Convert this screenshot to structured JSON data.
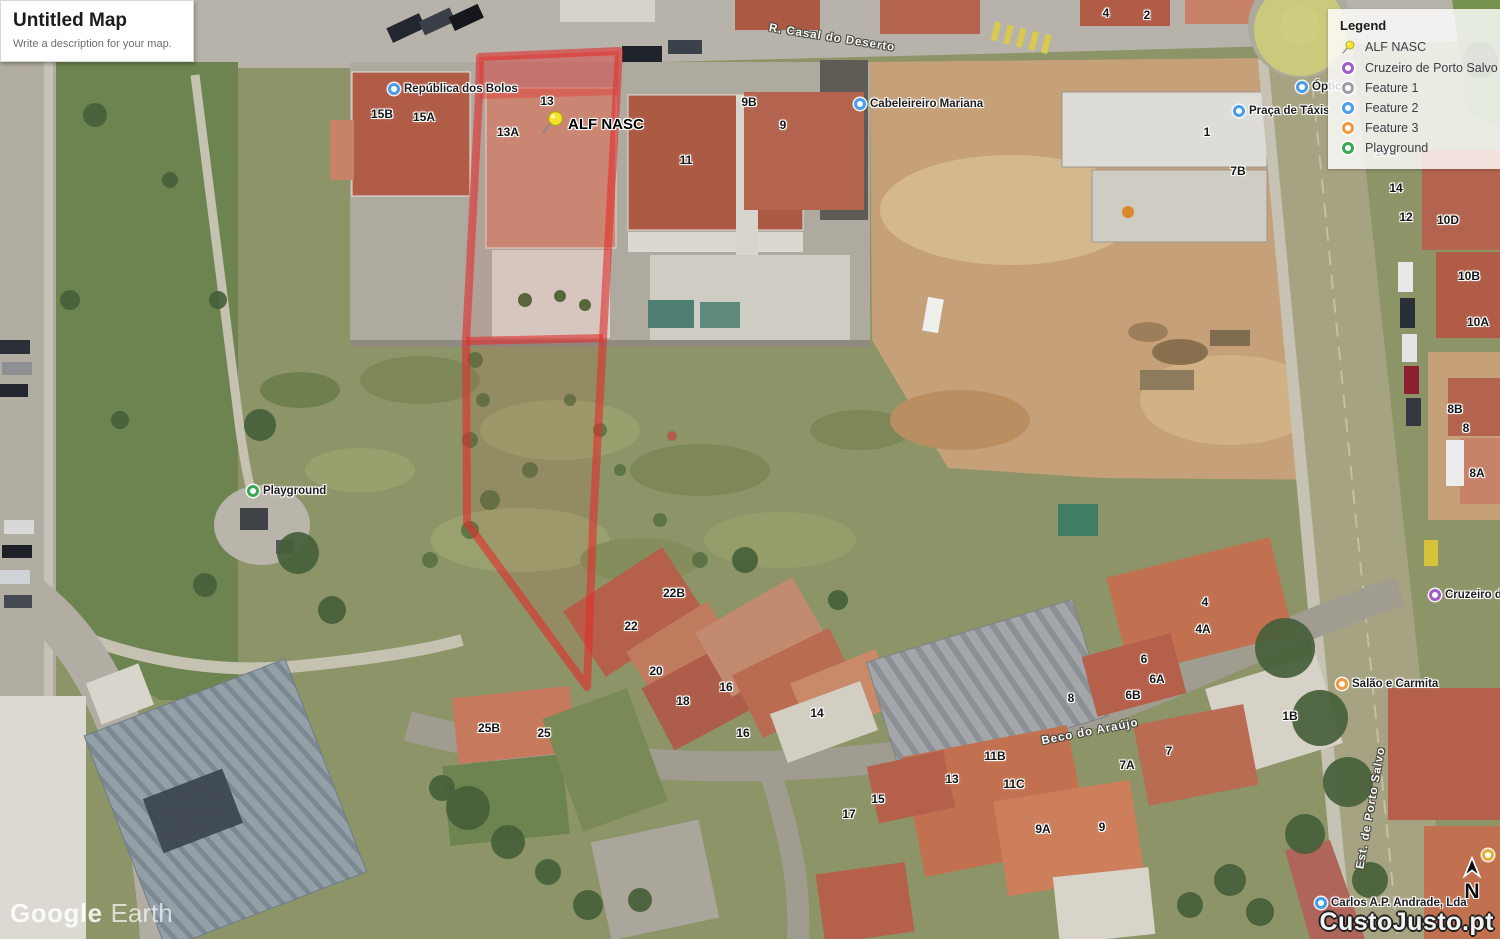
{
  "title_card": {
    "title": "Untitled Map",
    "description": "Write a description for your map."
  },
  "legend": {
    "header": "Legend",
    "items": [
      {
        "label": "ALF NASC",
        "icon": "pushpin",
        "color": "#e8d432"
      },
      {
        "label": "Cruzeiro de Porto Salvo",
        "icon": "circle",
        "color": "#a25bc9"
      },
      {
        "label": "Feature 1",
        "icon": "circle",
        "color": "#9aa0a6"
      },
      {
        "label": "Feature 2",
        "icon": "circle",
        "color": "#4a9de8"
      },
      {
        "label": "Feature 3",
        "icon": "circle",
        "color": "#ef9a3c"
      },
      {
        "label": "Playground",
        "icon": "circle",
        "color": "#3aa757"
      }
    ]
  },
  "placemark": {
    "label": "ALF NASC",
    "x": 552,
    "y": 124
  },
  "house_numbers": [
    {
      "label": "13",
      "x": 547,
      "y": 101
    },
    {
      "label": "13A",
      "x": 508,
      "y": 132
    },
    {
      "label": "15B",
      "x": 382,
      "y": 114
    },
    {
      "label": "15A",
      "x": 424,
      "y": 117
    },
    {
      "label": "11",
      "x": 686,
      "y": 160
    },
    {
      "label": "9B",
      "x": 749,
      "y": 102
    },
    {
      "label": "9",
      "x": 783,
      "y": 125
    },
    {
      "label": "4",
      "x": 1106,
      "y": 13
    },
    {
      "label": "2",
      "x": 1147,
      "y": 15
    },
    {
      "label": "1",
      "x": 1207,
      "y": 132
    },
    {
      "label": "7B",
      "x": 1238,
      "y": 171
    },
    {
      "label": "14A",
      "x": 1386,
      "y": 152
    },
    {
      "label": "14",
      "x": 1396,
      "y": 188
    },
    {
      "label": "12",
      "x": 1406,
      "y": 217
    },
    {
      "label": "10D",
      "x": 1448,
      "y": 220
    },
    {
      "label": "10B",
      "x": 1469,
      "y": 276
    },
    {
      "label": "10A",
      "x": 1478,
      "y": 322
    },
    {
      "label": "8B",
      "x": 1455,
      "y": 409
    },
    {
      "label": "8",
      "x": 1466,
      "y": 428
    },
    {
      "label": "8A",
      "x": 1477,
      "y": 473
    },
    {
      "label": "22B",
      "x": 674,
      "y": 593
    },
    {
      "label": "22",
      "x": 631,
      "y": 626
    },
    {
      "label": "20",
      "x": 656,
      "y": 671
    },
    {
      "label": "18",
      "x": 683,
      "y": 701
    },
    {
      "label": "16",
      "x": 726,
      "y": 687
    },
    {
      "label": "14",
      "x": 817,
      "y": 713
    },
    {
      "label": "16",
      "x": 743,
      "y": 733
    },
    {
      "label": "25B",
      "x": 489,
      "y": 728
    },
    {
      "label": "25",
      "x": 544,
      "y": 733
    },
    {
      "label": "4",
      "x": 1205,
      "y": 602
    },
    {
      "label": "4A",
      "x": 1203,
      "y": 629
    },
    {
      "label": "6",
      "x": 1144,
      "y": 659
    },
    {
      "label": "6A",
      "x": 1157,
      "y": 679
    },
    {
      "label": "6B",
      "x": 1133,
      "y": 695
    },
    {
      "label": "8",
      "x": 1071,
      "y": 698
    },
    {
      "label": "1B",
      "x": 1290,
      "y": 716
    },
    {
      "label": "7",
      "x": 1169,
      "y": 751
    },
    {
      "label": "7A",
      "x": 1127,
      "y": 765
    },
    {
      "label": "11B",
      "x": 995,
      "y": 756
    },
    {
      "label": "13",
      "x": 952,
      "y": 779
    },
    {
      "label": "11C",
      "x": 1014,
      "y": 784
    },
    {
      "label": "15",
      "x": 878,
      "y": 799
    },
    {
      "label": "17",
      "x": 849,
      "y": 814
    },
    {
      "label": "9A",
      "x": 1043,
      "y": 829
    },
    {
      "label": "9",
      "x": 1102,
      "y": 827
    }
  ],
  "poi_labels": [
    {
      "label": "República dos Bolos",
      "x": 395,
      "y": 89,
      "color": "#4a9de8"
    },
    {
      "label": "Cabeleireiro Mariana",
      "x": 861,
      "y": 104,
      "color": "#4a9de8"
    },
    {
      "label": "Praça de Táxis",
      "x": 1240,
      "y": 111,
      "color": "#4a9de8"
    },
    {
      "label": "Óptica",
      "x": 1303,
      "y": 87,
      "color": "#4a9de8"
    },
    {
      "label": "Playground",
      "x": 254,
      "y": 491,
      "color": "#3aa757"
    },
    {
      "label": "Salão e Carmita",
      "x": 1343,
      "y": 684,
      "color": "#ef9a3c"
    },
    {
      "label": "Cruzeiro de Porto Salvo",
      "x": 1436,
      "y": 595,
      "color": "#a25bc9"
    },
    {
      "label": "Carlos A.P. Andrade, Lda",
      "x": 1322,
      "y": 903,
      "color": "#4a9de8"
    },
    {
      "label": "",
      "x": 1489,
      "y": 855,
      "color": "#e2b13c"
    }
  ],
  "street_labels": [
    {
      "label": "R. Casal do Deserto",
      "x": 832,
      "y": 38,
      "rotation": 9
    },
    {
      "label": "Beco do Araújo",
      "x": 1090,
      "y": 732,
      "rotation": -11
    },
    {
      "label": "Est. de Porto Salvo",
      "x": 1371,
      "y": 808,
      "rotation": -80
    }
  ],
  "watermarks": {
    "brand": "Google",
    "product": "Earth",
    "site": "CustoJusto.pt"
  },
  "compass": {
    "label": "N"
  }
}
